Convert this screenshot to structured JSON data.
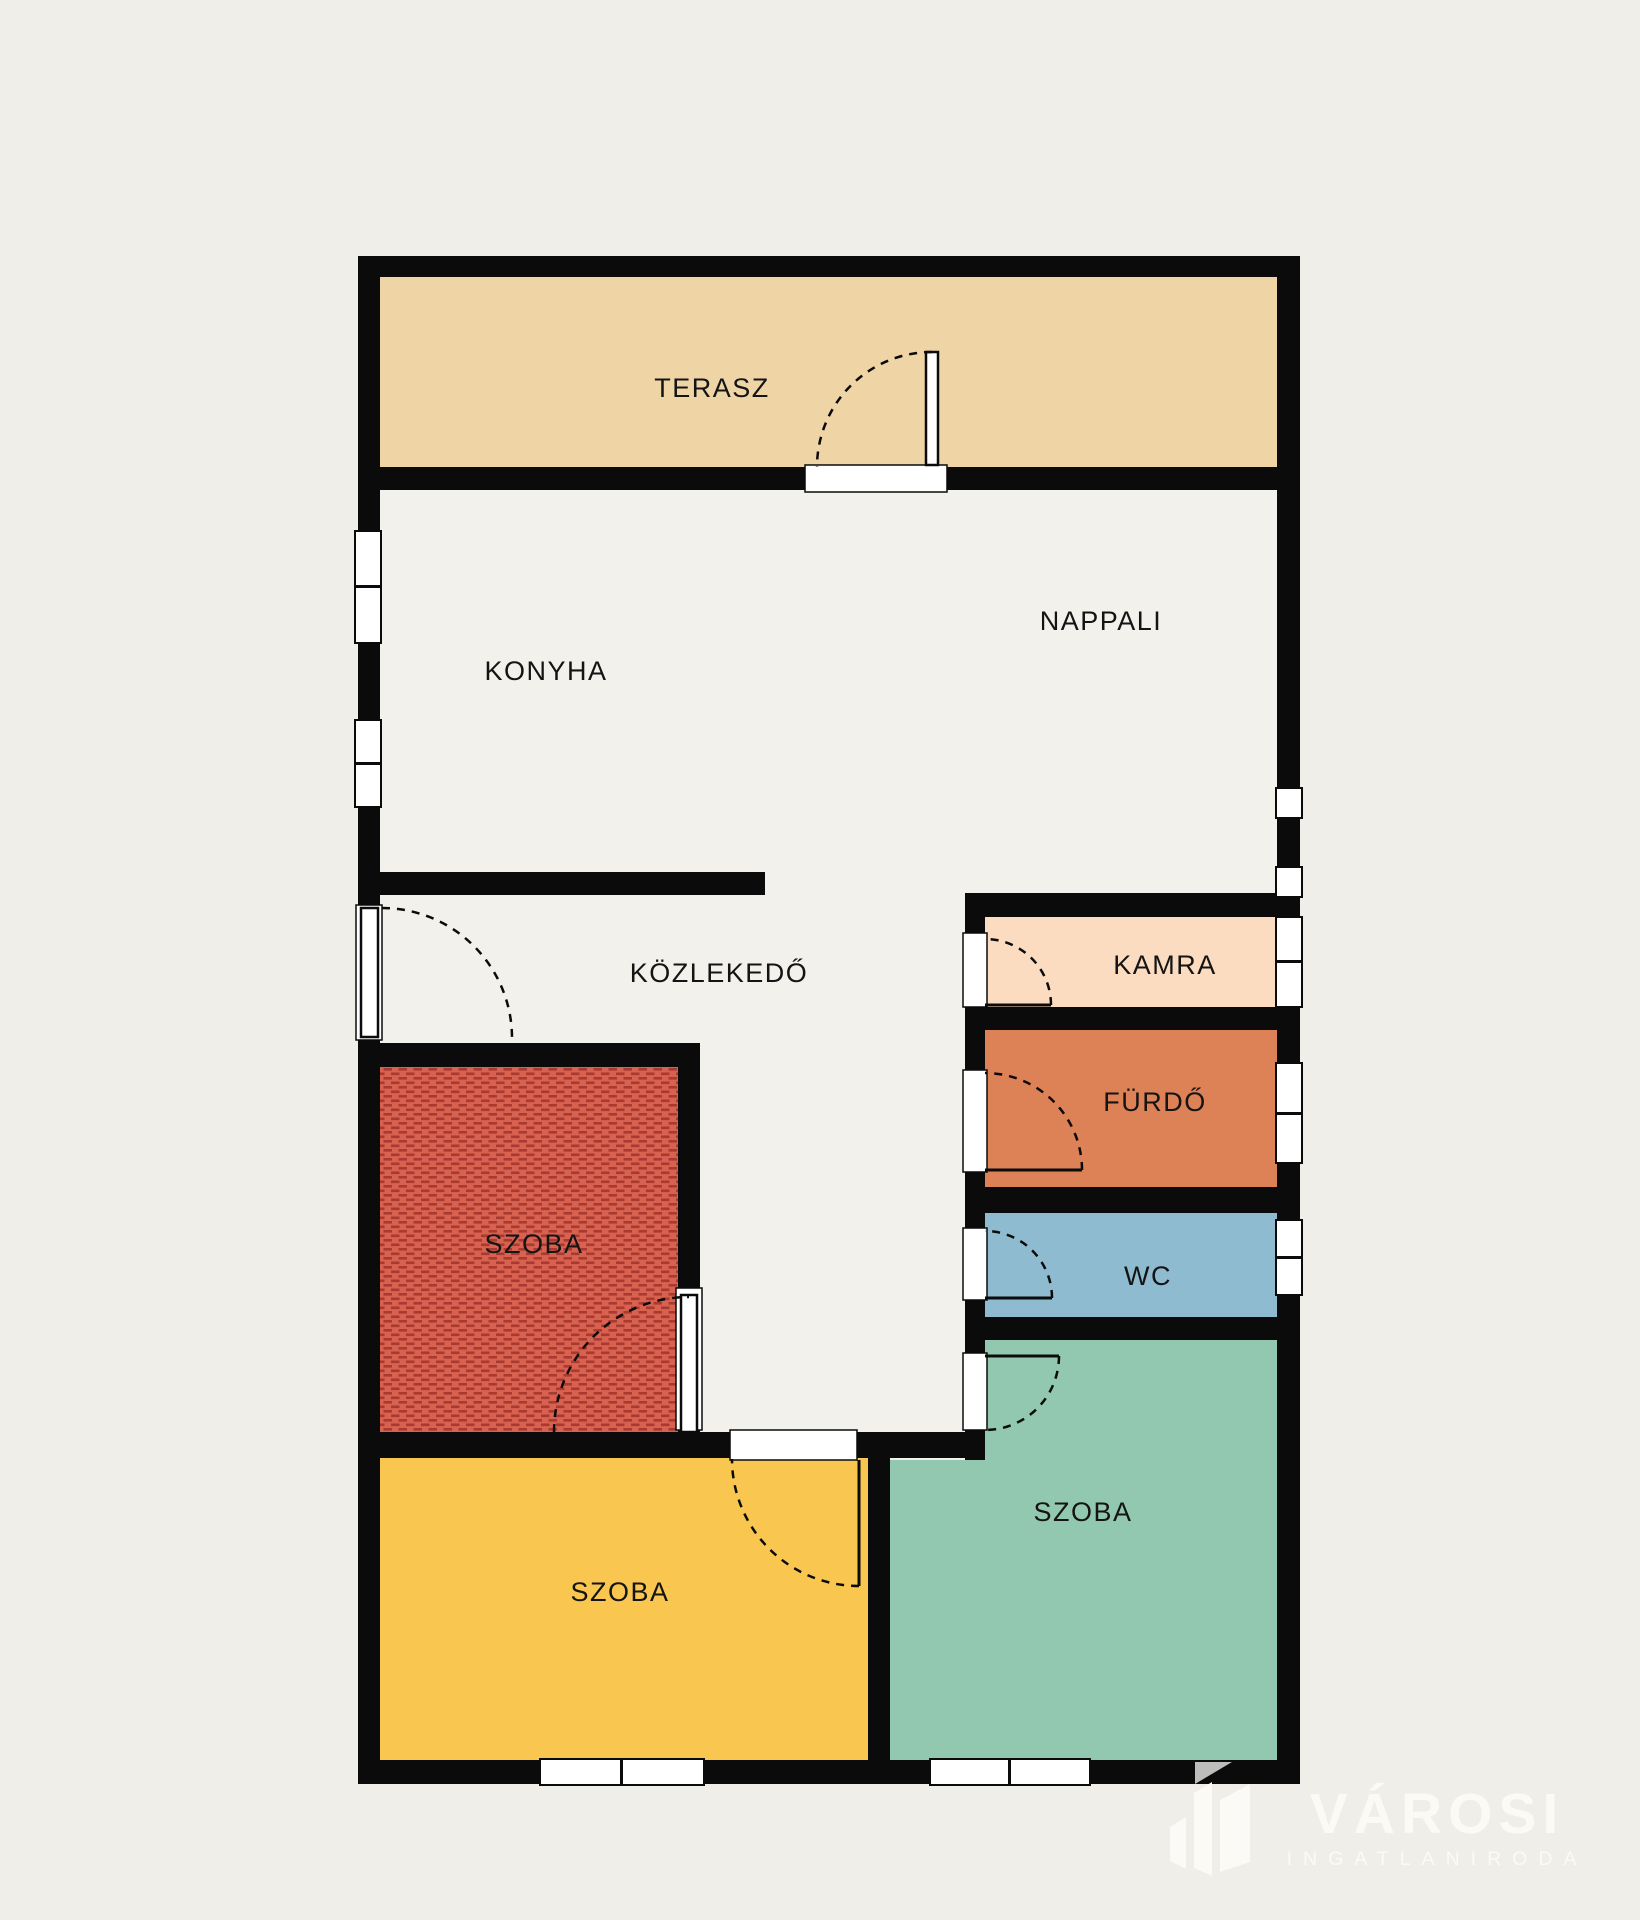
{
  "plan": {
    "rooms": [
      {
        "id": "terasz",
        "label": "TERASZ",
        "color": "#efd4a6",
        "label_x": 712,
        "label_y": 397
      },
      {
        "id": "konyha",
        "label": "KONYHA",
        "color": "#f2f1ec",
        "label_x": 546,
        "label_y": 680
      },
      {
        "id": "nappali",
        "label": "NAPPALI",
        "color": "#f2f1ec",
        "label_x": 1101,
        "label_y": 630
      },
      {
        "id": "kozlekedo",
        "label": "KÖZLEKEDŐ",
        "color": "#f2f1ec",
        "label_x": 719,
        "label_y": 982
      },
      {
        "id": "kamra",
        "label": "KAMRA",
        "color": "#fcdcc0",
        "label_x": 1165,
        "label_y": 974
      },
      {
        "id": "furdo",
        "label": "FÜRDŐ",
        "color": "#dd8156",
        "label_x": 1155,
        "label_y": 1111
      },
      {
        "id": "wc",
        "label": "WC",
        "color": "#8ebbd0",
        "label_x": 1148,
        "label_y": 1285
      },
      {
        "id": "szoba-1",
        "label": "SZOBA",
        "color": "#d96150",
        "hatch": "#a83b31",
        "label_x": 534,
        "label_y": 1253
      },
      {
        "id": "szoba-2",
        "label": "SZOBA",
        "color": "#f9c750",
        "label_x": 620,
        "label_y": 1601
      },
      {
        "id": "szoba-3",
        "label": "SZOBA",
        "color": "#93c8b0",
        "label_x": 1083,
        "label_y": 1521
      }
    ]
  },
  "colors": {
    "wall": "#0b0b0b",
    "floor": "#f2f1ec",
    "background": "#efeee9",
    "window": "#ffffff",
    "logo_white": "#fbfaf7",
    "logo_gray": "#bdbdbb"
  },
  "logo": {
    "brand": "VÁROSI",
    "tagline": "INGATLANIRODA"
  }
}
